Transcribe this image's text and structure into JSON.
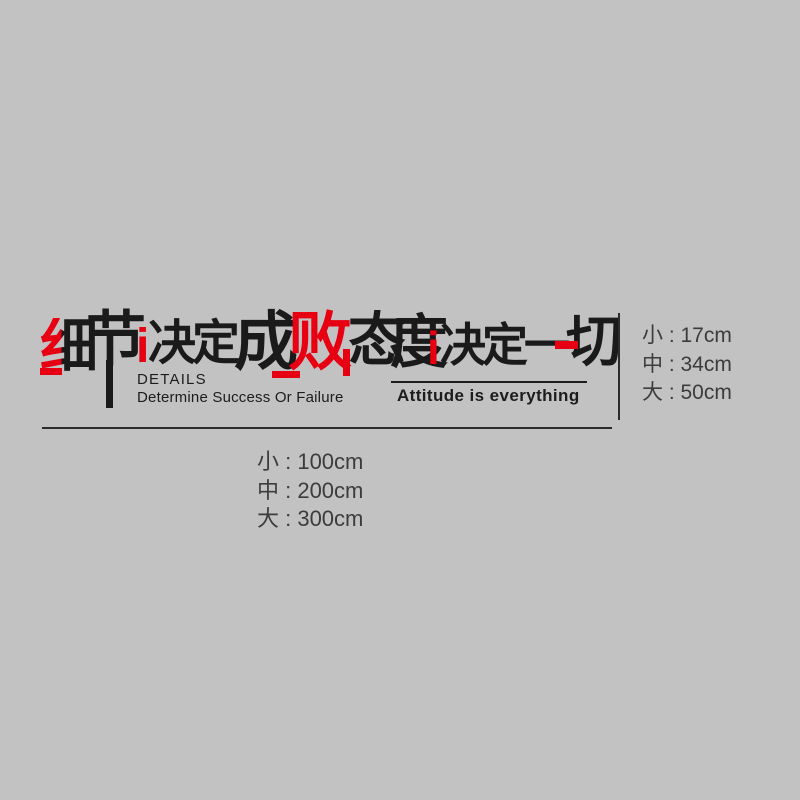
{
  "page": {
    "background_color": "#c2c2c2"
  },
  "colors": {
    "art_black": "#1a1a1a",
    "accent_red": "#e60012",
    "spec_text": "#3c3c3c",
    "rule_line": "#2b2b2b"
  },
  "decal": {
    "headline": {
      "phrase_left": "细节决定成败",
      "phrase_right": "态度决定一切",
      "segments": [
        {
          "text": "细",
          "color": "red-black-split"
        },
        {
          "text": "节",
          "color": "black"
        },
        {
          "text": "i",
          "color": "red"
        },
        {
          "text": "决",
          "color": "black"
        },
        {
          "text": "定",
          "color": "black"
        },
        {
          "text": "成",
          "color": "black"
        },
        {
          "text": "败",
          "color": "red"
        },
        {
          "text": "态",
          "color": "black"
        },
        {
          "text": "度",
          "color": "black"
        },
        {
          "text": "i",
          "color": "red"
        },
        {
          "text": "决",
          "color": "black"
        },
        {
          "text": "定",
          "color": "black"
        },
        {
          "text": "一",
          "color": "black"
        },
        {
          "text": "切",
          "color": "black"
        }
      ]
    },
    "english_left": {
      "line1": "DETAILS",
      "line2": "Determine Success Or Failure"
    },
    "english_right": "Attitude is everything"
  },
  "size_specs": {
    "heights": {
      "rows": [
        "小 : 17cm",
        "中 : 34cm",
        "大 : 50cm"
      ]
    },
    "widths": {
      "rows": [
        "小 : 100cm",
        "中 : 200cm",
        "大 : 300cm"
      ]
    }
  }
}
